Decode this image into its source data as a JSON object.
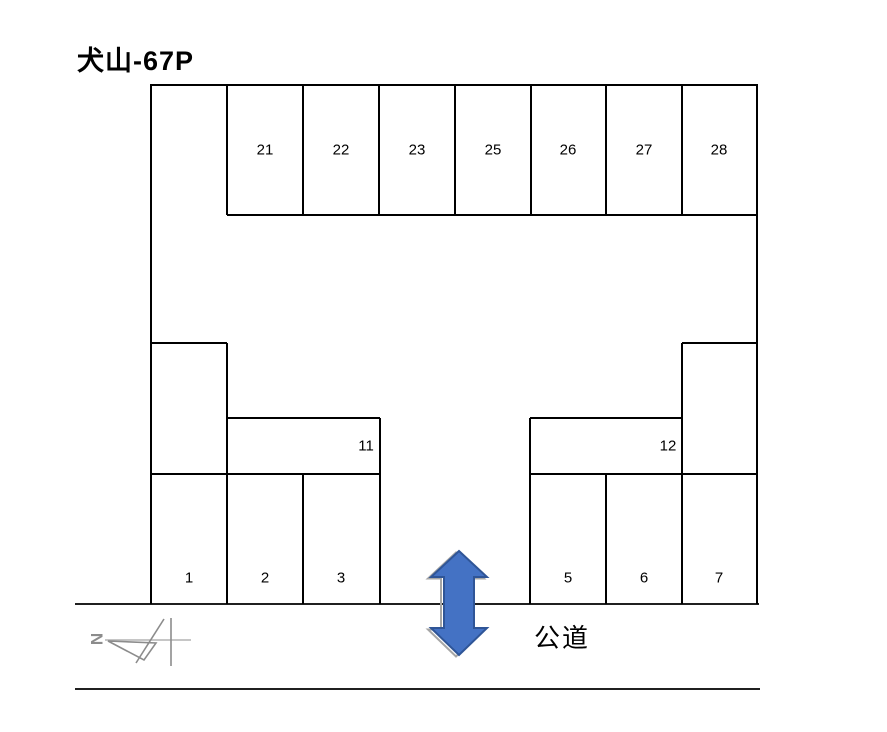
{
  "title": "犬山-67P",
  "road_label": "公道",
  "compass": {
    "north_letter": "N"
  },
  "lot": {
    "top_row": [
      "21",
      "22",
      "23",
      "25",
      "26",
      "27",
      "28"
    ],
    "mid_left_label": "11",
    "mid_right_label": "12",
    "bottom_left_row": [
      "1",
      "2",
      "3"
    ],
    "bottom_right_row": [
      "5",
      "6",
      "7"
    ]
  },
  "colors": {
    "line": "#000000",
    "arrow_fill": "#4472C4",
    "arrow_stroke": "#2F5597",
    "compass_gray": "#8C8C8C",
    "compass_light_gray": "#B3B3B3"
  }
}
